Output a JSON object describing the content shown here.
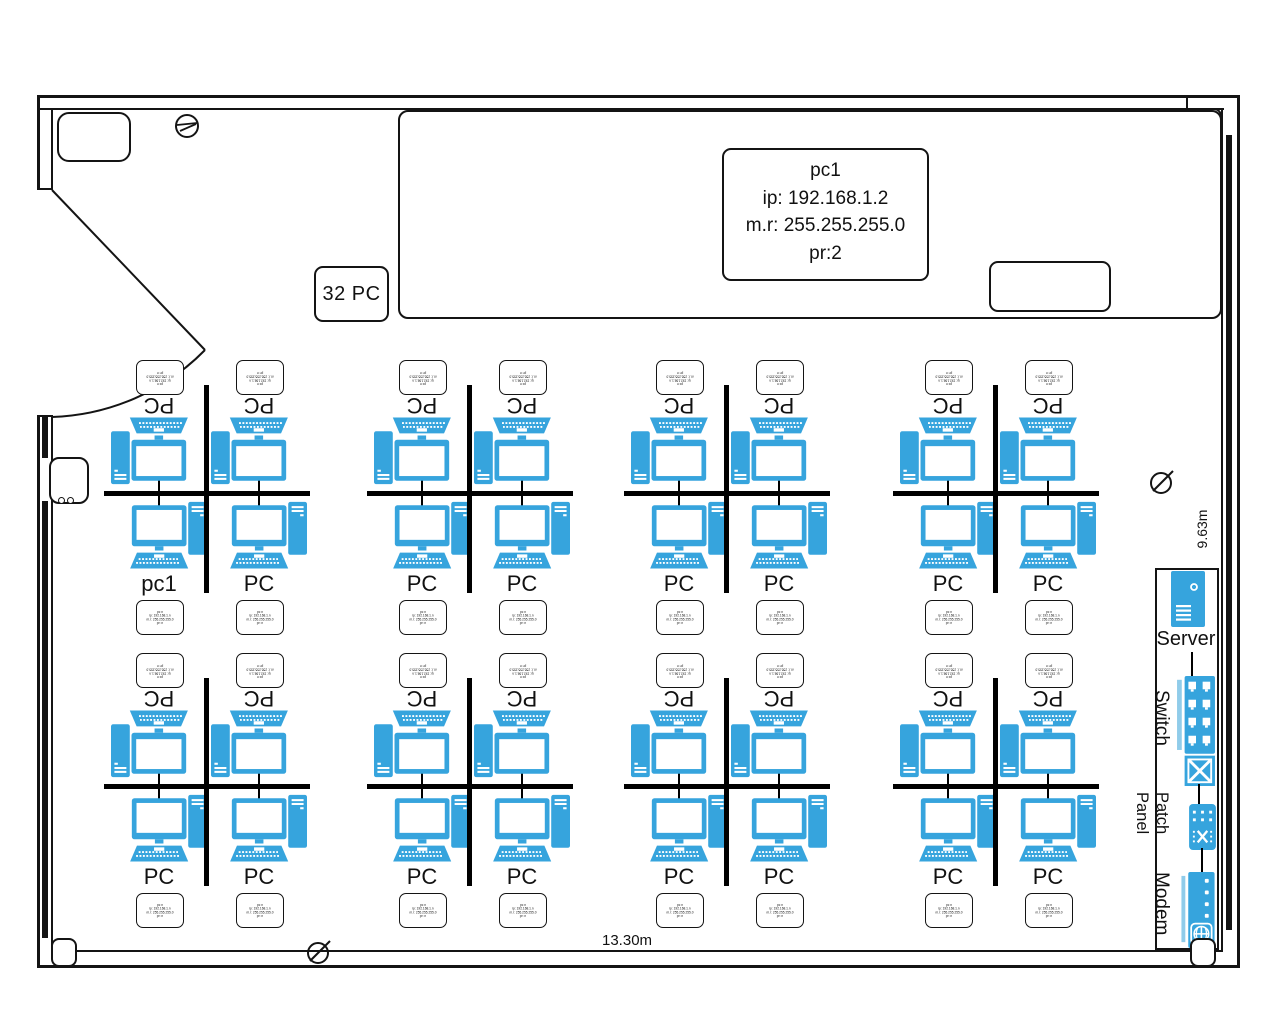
{
  "palette": {
    "device_blue": "#36A4DD",
    "device_blue_light": "#90CCEA",
    "wall": "#141414"
  },
  "dimensions": {
    "width_label": "13.30m",
    "height_label": "9.63m"
  },
  "capacity_box": {
    "label": "32 PC"
  },
  "callout": {
    "lines": [
      "pc1",
      "ip: 192.168.1.2",
      "m.r: 255.255.255.0",
      "pr:2"
    ]
  },
  "mini_card_lines": [
    "pc n",
    "ip: 192.168.1.n",
    "m.r: 255.255.255.0",
    "pr: n"
  ],
  "clusters": [
    {
      "pcs": [
        "PC",
        "PC",
        "pc1",
        "PC"
      ]
    },
    {
      "pcs": [
        "PC",
        "PC",
        "PC",
        "PC"
      ]
    },
    {
      "pcs": [
        "PC",
        "PC",
        "PC",
        "PC"
      ]
    },
    {
      "pcs": [
        "PC",
        "PC",
        "PC",
        "PC"
      ]
    },
    {
      "pcs": [
        "PC",
        "PC",
        "PC",
        "PC"
      ]
    },
    {
      "pcs": [
        "PC",
        "PC",
        "PC",
        "PC"
      ]
    },
    {
      "pcs": [
        "PC",
        "PC",
        "PC",
        "PC"
      ]
    },
    {
      "pcs": [
        "PC",
        "PC",
        "PC",
        "PC"
      ]
    }
  ],
  "rack": {
    "server_label": "Server",
    "switch_label": "Switch",
    "patch_panel": {
      "word1": "Patch",
      "word2": "Panel"
    },
    "modem_label": "Modem"
  }
}
